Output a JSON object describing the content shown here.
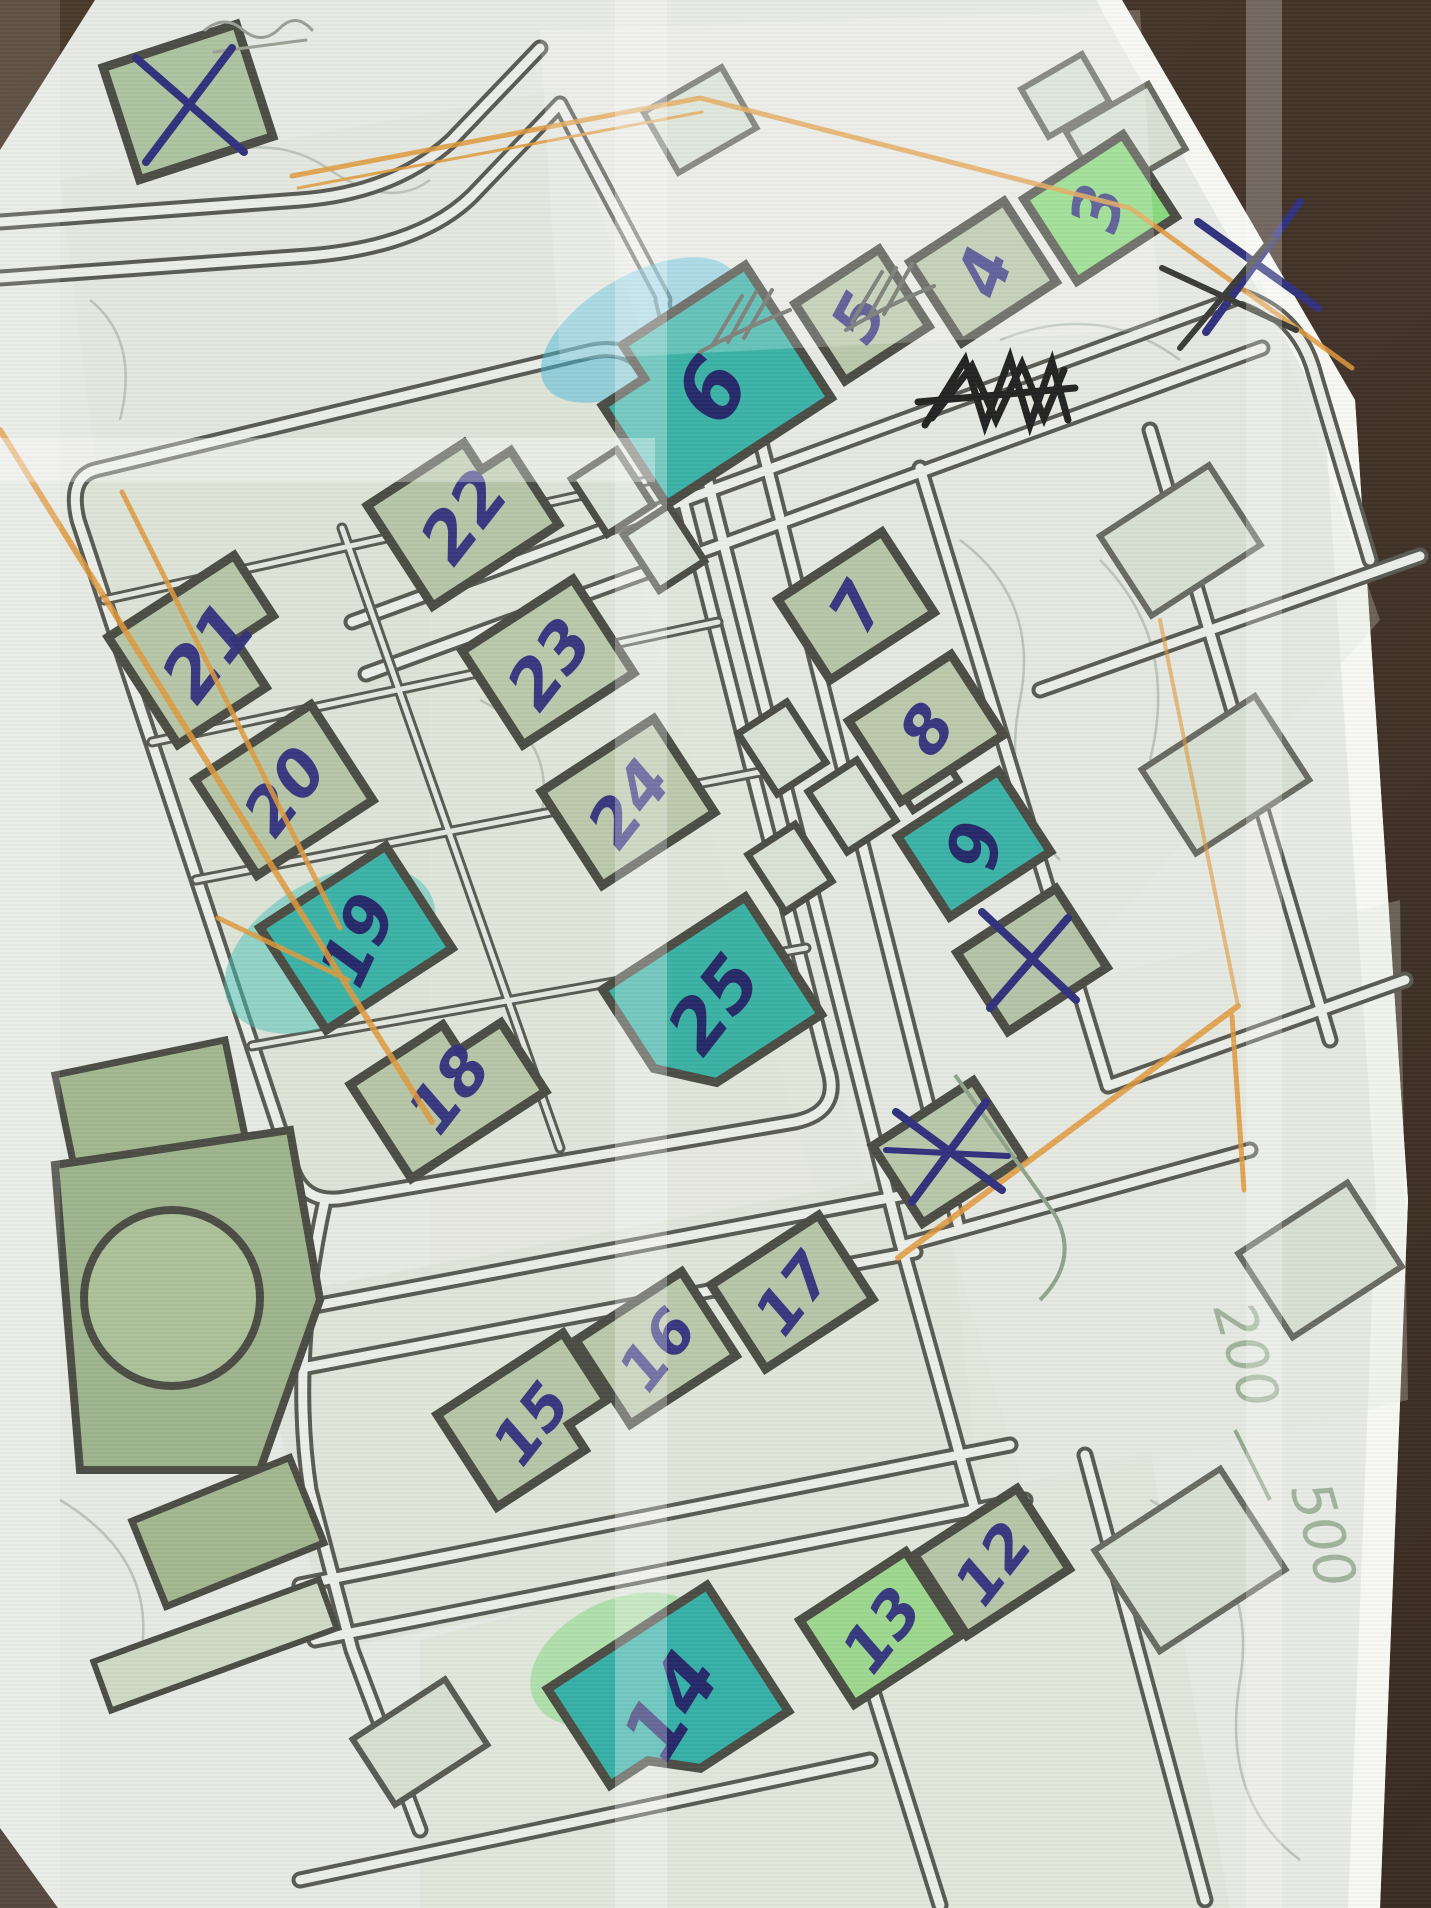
{
  "photo": {
    "surface": "dark-brown tabletop",
    "surface_color": "#44352a",
    "paper_color": "#e8eae5",
    "paper_edge_color": "#f7f8f4"
  },
  "map": {
    "colors": {
      "street_ink": "#5a5b53",
      "building_outline": "#4c4d45",
      "building_sage": "#b7c6a8",
      "building_bright_green": "#8bd97f",
      "building_teal": "#3db3a8",
      "building_pale": "#d8e0d2",
      "park_green": "#a3b890",
      "pen_blue": "#32327e",
      "pencil_orange": "#e09a3e",
      "pencil_graphite": "#5f625a",
      "scribble_black": "#242424"
    },
    "buildings": [
      {
        "id": "b3",
        "label": "3",
        "highlight": "bright-green"
      },
      {
        "id": "b4",
        "label": "4",
        "highlight": "sage"
      },
      {
        "id": "b5",
        "label": "5",
        "highlight": "sage"
      },
      {
        "id": "b6",
        "label": "6",
        "highlight": "teal"
      },
      {
        "id": "b7",
        "label": "7",
        "highlight": "sage"
      },
      {
        "id": "b8",
        "label": "8",
        "highlight": "sage"
      },
      {
        "id": "b9",
        "label": "9",
        "highlight": "teal"
      },
      {
        "id": "b12",
        "label": "12",
        "highlight": "sage"
      },
      {
        "id": "b13",
        "label": "13",
        "highlight": "bright-green"
      },
      {
        "id": "b14",
        "label": "14",
        "highlight": "teal"
      },
      {
        "id": "b15",
        "label": "15",
        "highlight": "sage"
      },
      {
        "id": "b16",
        "label": "16",
        "highlight": "sage"
      },
      {
        "id": "b17",
        "label": "17",
        "highlight": "sage"
      },
      {
        "id": "b18",
        "label": "18",
        "highlight": "sage"
      },
      {
        "id": "b19",
        "label": "19",
        "highlight": "teal"
      },
      {
        "id": "b20",
        "label": "20",
        "highlight": "sage"
      },
      {
        "id": "b21",
        "label": "21",
        "highlight": "sage"
      },
      {
        "id": "b22",
        "label": "22",
        "highlight": "sage"
      },
      {
        "id": "b23",
        "label": "23",
        "highlight": "sage"
      },
      {
        "id": "b24",
        "label": "24",
        "highlight": "sage"
      },
      {
        "id": "b25",
        "label": "25",
        "highlight": "teal"
      }
    ],
    "pencil_texts": [
      "200",
      "500"
    ],
    "x_marks": [
      {
        "name": "crossed-building-top-left",
        "medium": "blue pen"
      },
      {
        "name": "crossed-mark-top-right-on-paper",
        "medium": "blue pen over graphite"
      },
      {
        "name": "crossed-building-below-9",
        "medium": "blue pen"
      },
      {
        "name": "crossed-building-lower-middle",
        "medium": "blue pen"
      }
    ],
    "scribbles": [
      {
        "name": "black-ink-scratch-out",
        "location": "upper-right"
      },
      {
        "name": "graphite-tally-marks-1",
        "location": "below building 5"
      },
      {
        "name": "graphite-tally-marks-2",
        "location": "below building 4"
      },
      {
        "name": "graphite-handwriting",
        "location": "top-left corner"
      }
    ]
  }
}
